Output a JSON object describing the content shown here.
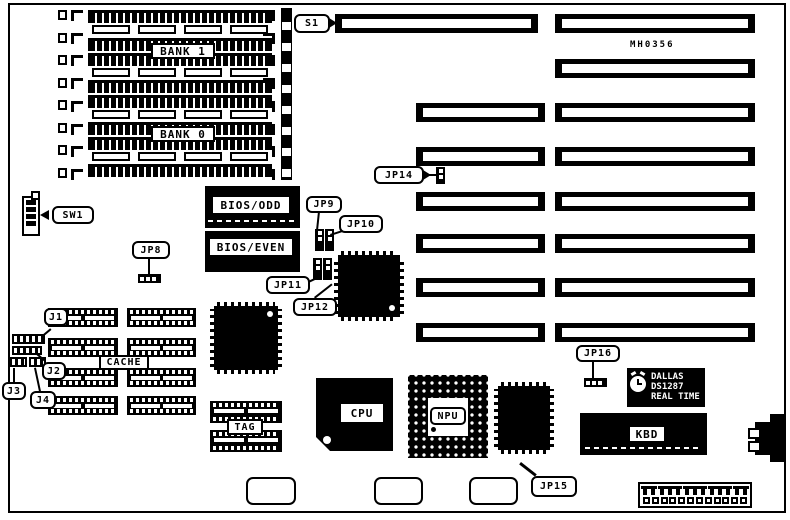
{
  "figure": {
    "part_number": "MH0356",
    "memory": {
      "bank1": "BANK 1",
      "bank0": "BANK 0"
    },
    "callouts": {
      "s1": "S1",
      "sw1": "SW1",
      "jp8": "JP8",
      "jp9": "JP9",
      "jp10": "JP10",
      "jp11": "JP11",
      "jp12": "JP12",
      "jp14": "JP14",
      "jp15": "JP15",
      "jp16": "JP16",
      "j1": "J1",
      "j2": "J2",
      "j3": "J3",
      "j4": "J4"
    },
    "chips": {
      "bios_odd": "BIOS/ODD",
      "bios_even": "BIOS/EVEN",
      "cache": "CACHE",
      "tag": "TAG",
      "cpu": "CPU",
      "npu": "NPU",
      "kbd": "KBD"
    },
    "rtc": {
      "brand": "DALLAS",
      "model": "DS1287",
      "tagline": "REAL TIME"
    },
    "colors": {
      "ink": "#000000",
      "paper": "#ffffff"
    }
  }
}
